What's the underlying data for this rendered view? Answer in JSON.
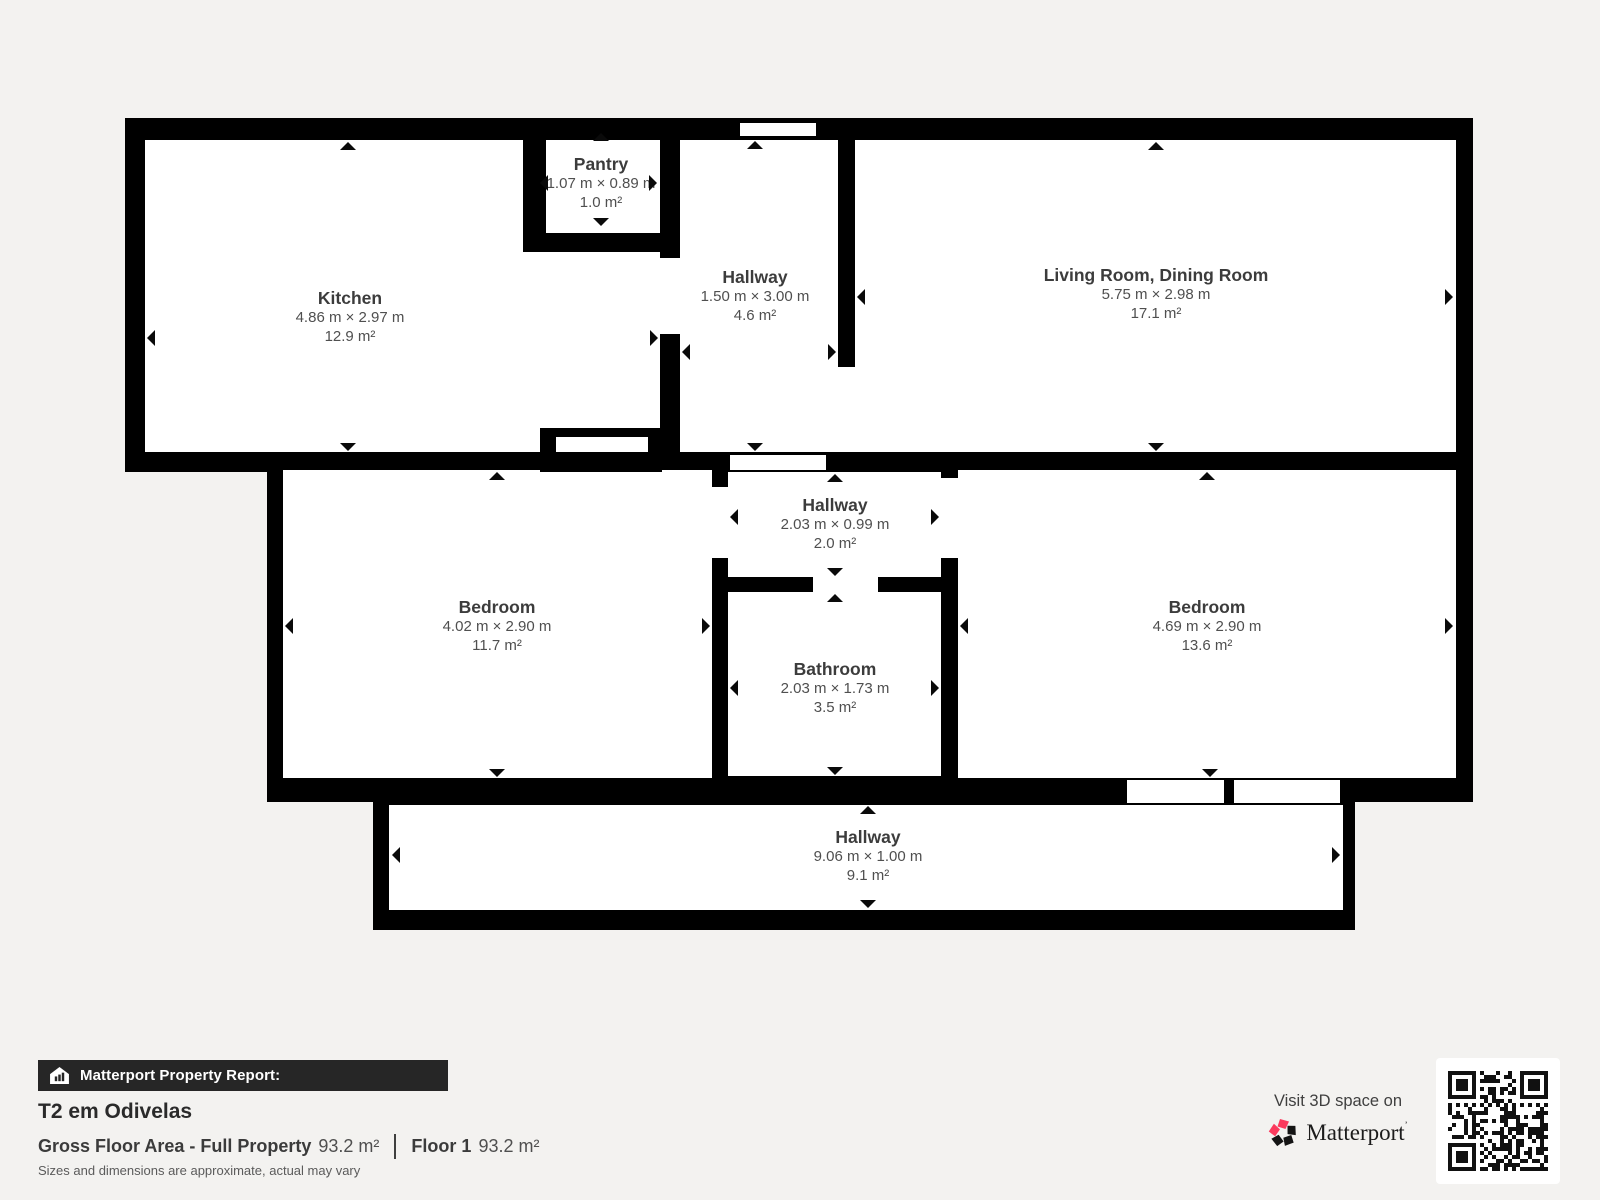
{
  "rooms": [
    {
      "name": "Pantry",
      "dims": "1.07 m × 0.89 m",
      "area": "1.0 m²"
    },
    {
      "name": "Kitchen",
      "dims": "4.86 m × 2.97 m",
      "area": "12.9 m²"
    },
    {
      "name": "Hallway",
      "dims": "1.50 m × 3.00 m",
      "area": "4.6 m²"
    },
    {
      "name": "Living Room, Dining Room",
      "dims": "5.75 m × 2.98 m",
      "area": "17.1 m²"
    },
    {
      "name": "Hallway",
      "dims": "2.03 m × 0.99 m",
      "area": "2.0 m²"
    },
    {
      "name": "Bedroom",
      "dims": "4.02 m × 2.90 m",
      "area": "11.7 m²"
    },
    {
      "name": "Bathroom",
      "dims": "2.03 m × 1.73 m",
      "area": "3.5 m²"
    },
    {
      "name": "Bedroom",
      "dims": "4.69 m × 2.90 m",
      "area": "13.6 m²"
    },
    {
      "name": "Hallway",
      "dims": "9.06 m × 1.00 m",
      "area": "9.1 m²"
    }
  ],
  "footer": {
    "report_label": "Matterport Property Report:",
    "property_title": "T2 em Odivelas",
    "gross_label": "Gross Floor Area - Full Property",
    "gross_value": "93.2 m²",
    "floor_label": "Floor 1",
    "floor_value": "93.2 m²",
    "disclaimer": "Sizes and dimensions are approximate, actual may vary",
    "visit_text": "Visit 3D space on",
    "brand": "Matterport",
    "brand_mark": "’"
  },
  "colors": {
    "background": "#f3f2f0",
    "wall": "#000000",
    "room_fill": "#ffffff",
    "label_text": "#4a4a4a",
    "bar_bg": "#262626",
    "accent_red": "#fb3a5d"
  }
}
